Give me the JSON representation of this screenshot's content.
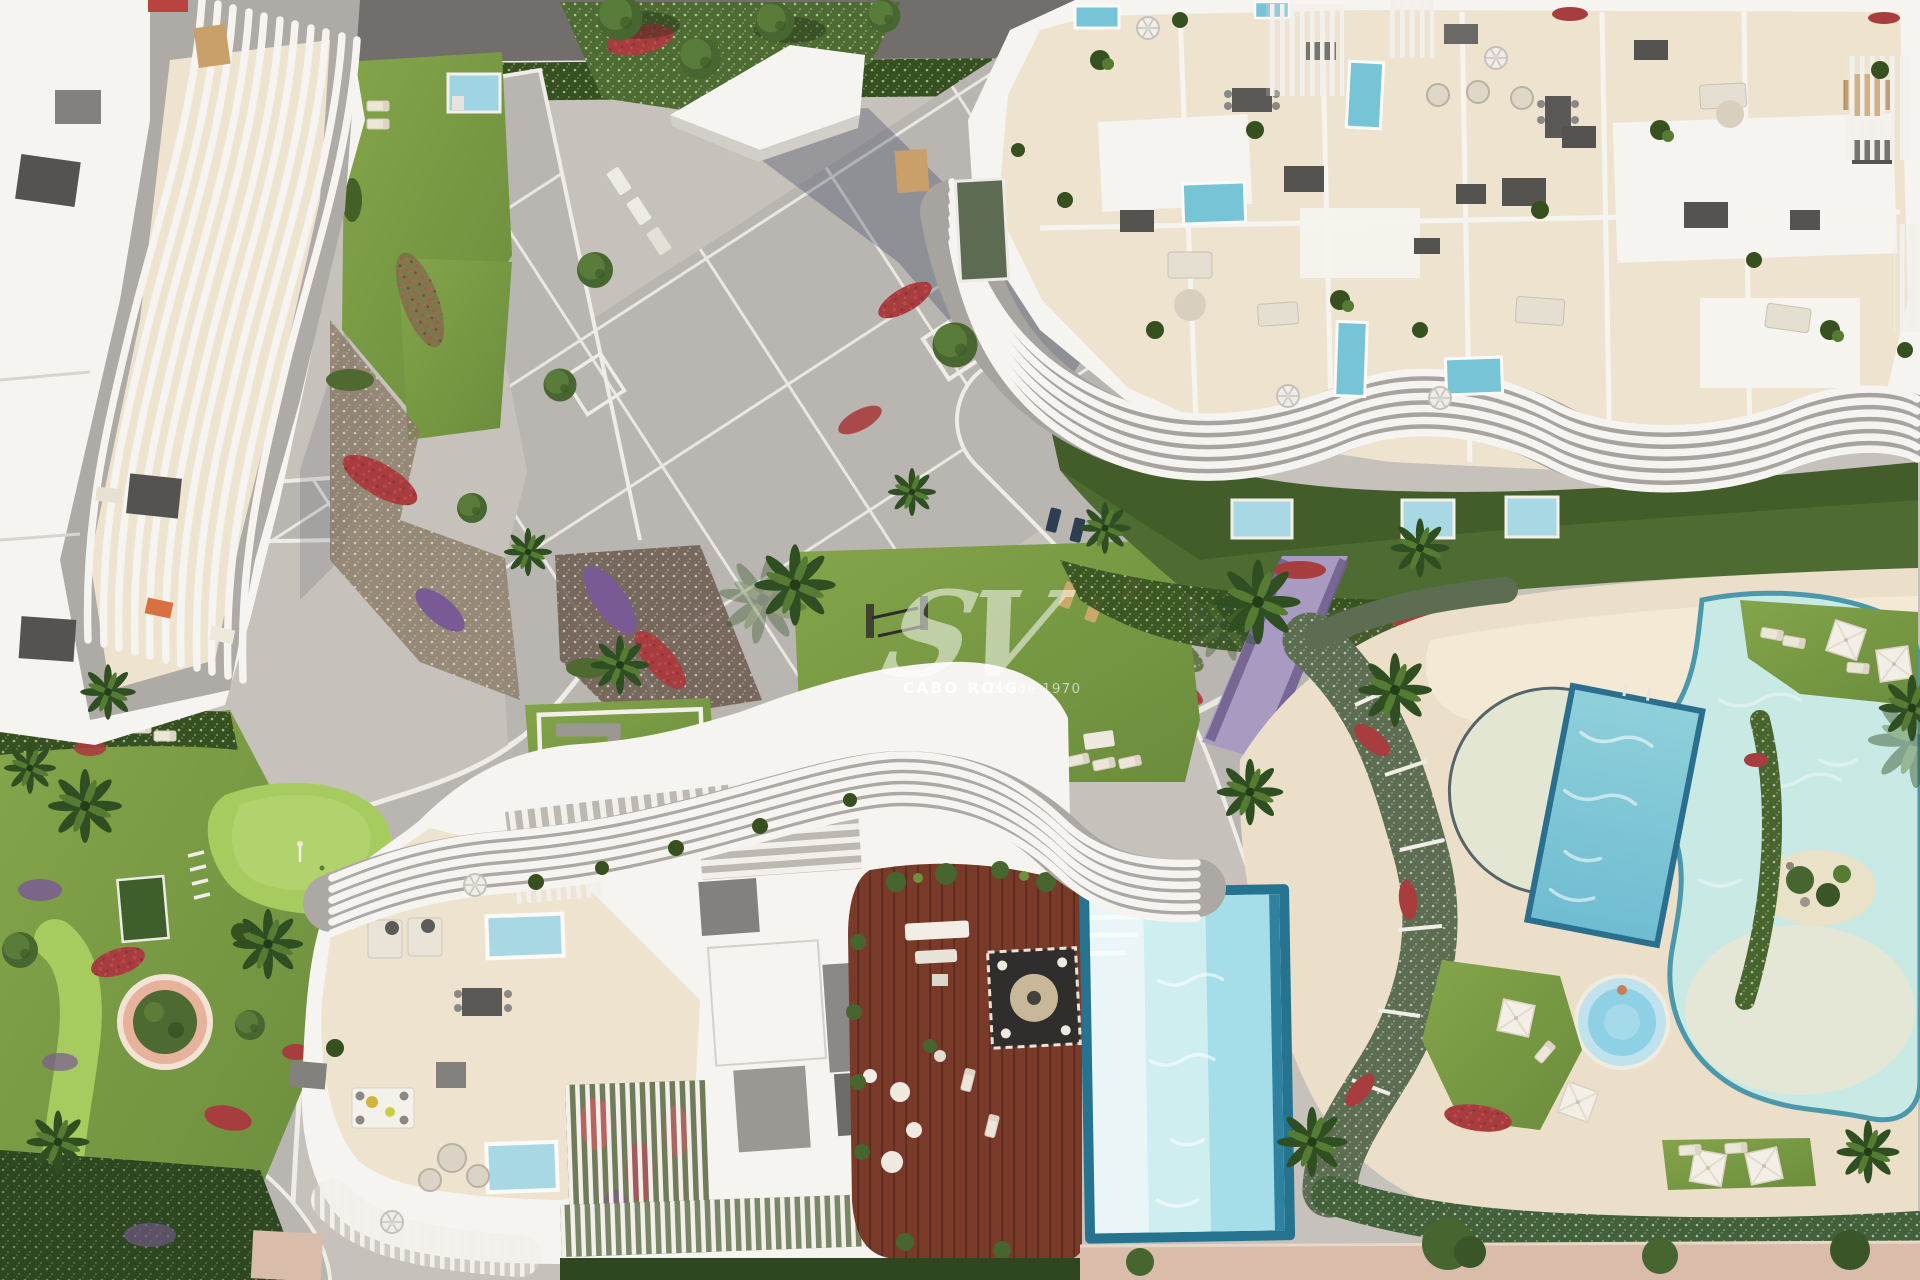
{
  "watermark": {
    "logo": "SV",
    "brand": "CABO ROIG",
    "tagline": "Desde 1970"
  },
  "palette": {
    "road": "#716e6b",
    "pave": "#b9b5b1",
    "grid": "#eae7e3",
    "cream": "#eee3cf",
    "deckCream": "#ecdfc9",
    "white": "#f6f4f0",
    "shade": "#aeaaa5",
    "box": "#83817d",
    "darkBox": "#55534f",
    "grass": "#76963f",
    "grassLight": "#8fb04e",
    "grassDark": "#4e6c31",
    "putting": "#a7cb5e",
    "hedge": "#36501f",
    "red": "#a83d3f",
    "purple": "#7a5a94",
    "lavender": "#a194bd",
    "wood": "#7a3a2a",
    "woodDark": "#5c2c1f",
    "poolBlue": "#77c4d6",
    "poolDeep": "#2b6f8e",
    "poolPale": "#e9f5f6",
    "lagoon": "#c9e9e5",
    "lagoonEdge": "#4b98ab",
    "sand": "#e9e1c8",
    "pink": "#d9bca9",
    "planterPink": "#e7b29c",
    "treeGreen": "#47652e",
    "palmGreen": "#2f4f22",
    "watermark": "#ffffff"
  }
}
